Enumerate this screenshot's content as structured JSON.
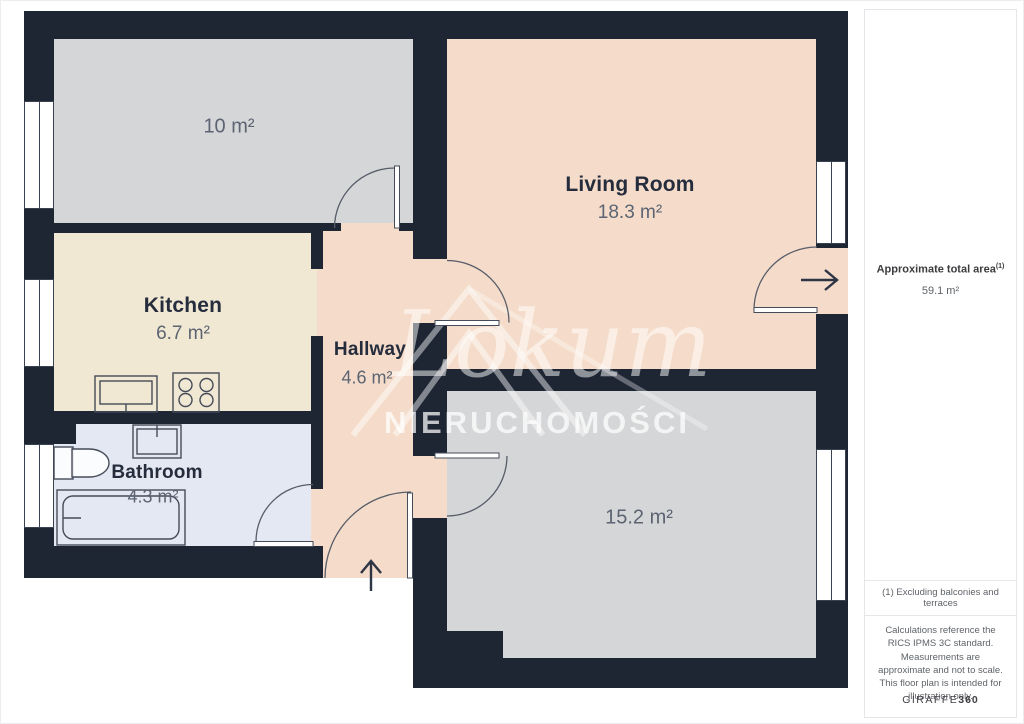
{
  "floorplan": {
    "rooms": [
      {
        "id": "room-10",
        "name": "",
        "area": "10 m²"
      },
      {
        "id": "kitchen",
        "name": "Kitchen",
        "area": "6.7 m²"
      },
      {
        "id": "hallway",
        "name": "Hallway",
        "area": "4.6 m²"
      },
      {
        "id": "living-room",
        "name": "Living Room",
        "area": "18.3 m²"
      },
      {
        "id": "bathroom",
        "name": "Bathroom",
        "area": "4.3 m²"
      },
      {
        "id": "room-15",
        "name": "",
        "area": "15.2 m²"
      }
    ],
    "watermark": {
      "script": "Lokum",
      "subtitle": "NIERUCHOMOŚCI"
    },
    "colors": {
      "wall": "#1e2634",
      "room_gray": "#d5d6d8",
      "kitchen": "#f1e8d3",
      "bathroom": "#e4e8f2",
      "warm_rooms": "#f5dcca"
    }
  },
  "sidebar": {
    "total_area": {
      "label": "Approximate total area",
      "superscript": "(1)",
      "value": "59.1 m²"
    },
    "footnote": "(1) Excluding balconies and terraces",
    "disclaimer": "Calculations reference the RICS IPMS 3C standard. Measurements are approximate and not to scale. This floor plan is intended for illustration only.",
    "brand": {
      "name": "GIRAFFE",
      "suffix": "360"
    }
  }
}
